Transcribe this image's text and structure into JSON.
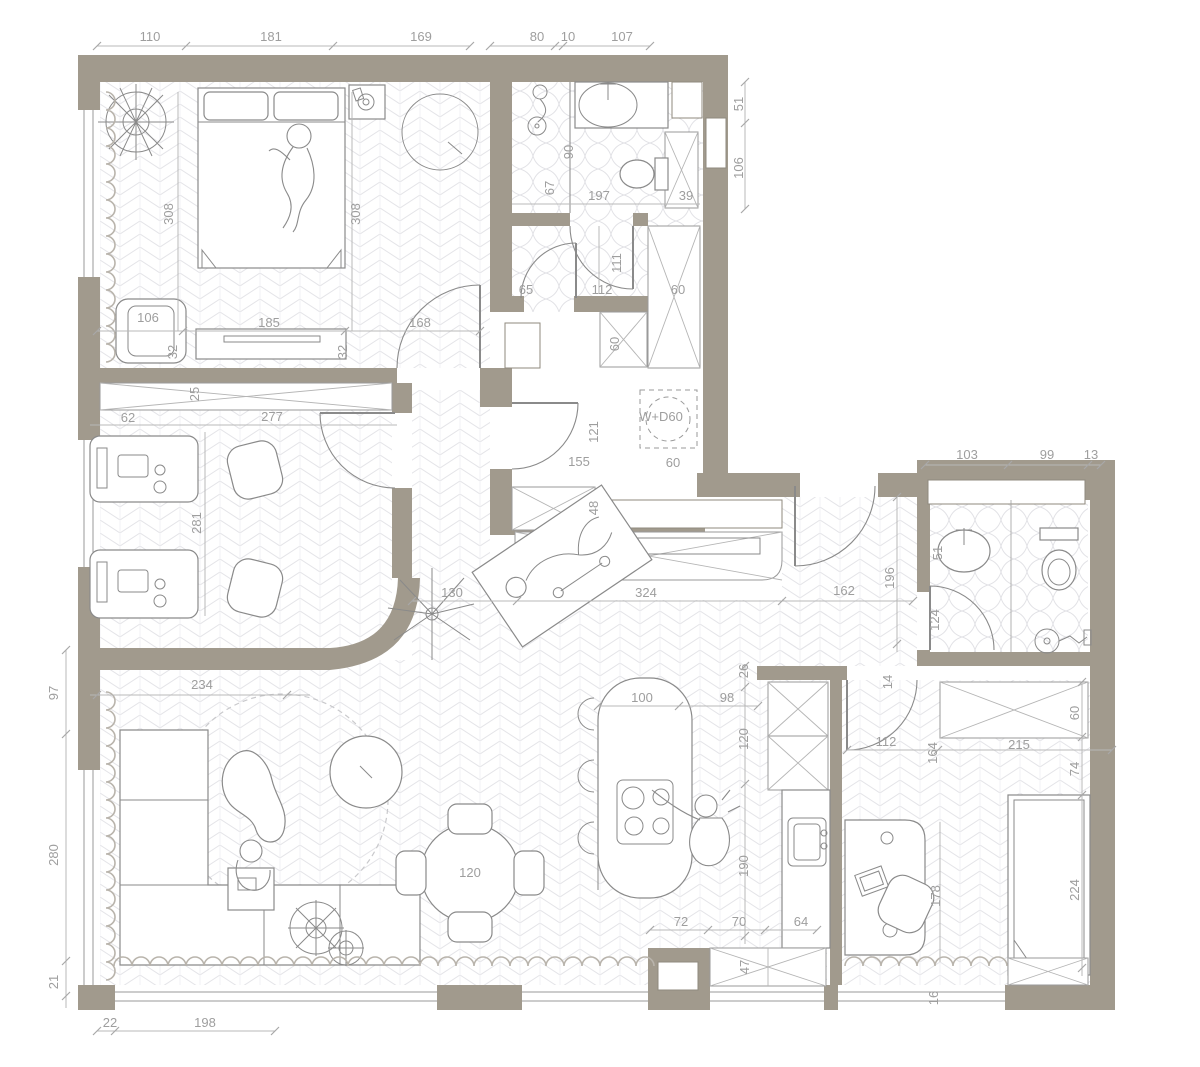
{
  "title": "Apartment floor plan with dimensions",
  "colors": {
    "wall": "#a19a8d",
    "dim_text": "#9e9e9e",
    "dim_line": "#b8b8b8",
    "furniture_line": "#8a8a8a",
    "curtain": "#b9b4ac",
    "floor_pattern": "#e4e4e8"
  },
  "labels": [
    {
      "t": "110",
      "x": 150,
      "y": 41
    },
    {
      "t": "181",
      "x": 271,
      "y": 41
    },
    {
      "t": "169",
      "x": 421,
      "y": 41
    },
    {
      "t": "80",
      "x": 537,
      "y": 41
    },
    {
      "t": "10",
      "x": 568,
      "y": 41
    },
    {
      "t": "107",
      "x": 622,
      "y": 41
    },
    {
      "t": "51",
      "x": 743,
      "y": 104,
      "r": 1
    },
    {
      "t": "106",
      "x": 743,
      "y": 168,
      "r": 1
    },
    {
      "t": "90",
      "x": 573,
      "y": 152,
      "r": 1
    },
    {
      "t": "67",
      "x": 554,
      "y": 188,
      "r": 1
    },
    {
      "t": "197",
      "x": 599,
      "y": 200
    },
    {
      "t": "39",
      "x": 686,
      "y": 200
    },
    {
      "t": "65",
      "x": 526,
      "y": 294
    },
    {
      "t": "112",
      "x": 602,
      "y": 294
    },
    {
      "t": "60",
      "x": 678,
      "y": 294
    },
    {
      "t": "111",
      "x": 621,
      "y": 263,
      "r": 1
    },
    {
      "t": "60",
      "x": 619,
      "y": 344,
      "r": 1
    },
    {
      "t": "308",
      "x": 173,
      "y": 214,
      "r": 1
    },
    {
      "t": "308",
      "x": 360,
      "y": 214,
      "r": 1
    },
    {
      "t": "106",
      "x": 148,
      "y": 322
    },
    {
      "t": "185",
      "x": 269,
      "y": 327
    },
    {
      "t": "168",
      "x": 420,
      "y": 327
    },
    {
      "t": "32",
      "x": 177,
      "y": 352,
      "r": 1
    },
    {
      "t": "32",
      "x": 347,
      "y": 352,
      "r": 1
    },
    {
      "t": "25",
      "x": 199,
      "y": 394,
      "r": 1
    },
    {
      "t": "62",
      "x": 128,
      "y": 422
    },
    {
      "t": "277",
      "x": 272,
      "y": 421
    },
    {
      "t": "281",
      "x": 201,
      "y": 523,
      "r": 1
    },
    {
      "t": "121",
      "x": 598,
      "y": 432,
      "r": 1
    },
    {
      "t": "W+D60",
      "x": 661,
      "y": 421
    },
    {
      "t": "155",
      "x": 579,
      "y": 466
    },
    {
      "t": "60",
      "x": 673,
      "y": 467
    },
    {
      "t": "48",
      "x": 598,
      "y": 508,
      "r": 1
    },
    {
      "t": "130",
      "x": 452,
      "y": 597
    },
    {
      "t": "324",
      "x": 646,
      "y": 597
    },
    {
      "t": "162",
      "x": 844,
      "y": 595
    },
    {
      "t": "196",
      "x": 894,
      "y": 578,
      "r": 1
    },
    {
      "t": "103",
      "x": 967,
      "y": 459
    },
    {
      "t": "99",
      "x": 1047,
      "y": 459
    },
    {
      "t": "13",
      "x": 1091,
      "y": 459
    },
    {
      "t": "51",
      "x": 942,
      "y": 553,
      "r": 1
    },
    {
      "t": "124",
      "x": 939,
      "y": 620,
      "r": 1
    },
    {
      "t": "26",
      "x": 748,
      "y": 671,
      "r": 1
    },
    {
      "t": "120",
      "x": 748,
      "y": 739,
      "r": 1
    },
    {
      "t": "190",
      "x": 748,
      "y": 866,
      "r": 1
    },
    {
      "t": "14",
      "x": 892,
      "y": 682,
      "r": 1
    },
    {
      "t": "112",
      "x": 886,
      "y": 746
    },
    {
      "t": "164",
      "x": 937,
      "y": 753,
      "r": 1
    },
    {
      "t": "215",
      "x": 1019,
      "y": 749
    },
    {
      "t": "74",
      "x": 1079,
      "y": 769,
      "r": 1
    },
    {
      "t": "60",
      "x": 1079,
      "y": 713,
      "r": 1
    },
    {
      "t": "224",
      "x": 1079,
      "y": 890,
      "r": 1
    },
    {
      "t": "178",
      "x": 940,
      "y": 896,
      "r": 1
    },
    {
      "t": "16",
      "x": 938,
      "y": 998,
      "r": 1
    },
    {
      "t": "100",
      "x": 642,
      "y": 702
    },
    {
      "t": "98",
      "x": 727,
      "y": 702
    },
    {
      "t": "72",
      "x": 681,
      "y": 926
    },
    {
      "t": "70",
      "x": 739,
      "y": 926
    },
    {
      "t": "64",
      "x": 801,
      "y": 926
    },
    {
      "t": "47",
      "x": 749,
      "y": 967,
      "r": 1
    },
    {
      "t": "97",
      "x": 58,
      "y": 693,
      "r": 1
    },
    {
      "t": "280",
      "x": 58,
      "y": 855,
      "r": 1
    },
    {
      "t": "21",
      "x": 58,
      "y": 982,
      "r": 1
    },
    {
      "t": "22",
      "x": 110,
      "y": 1027
    },
    {
      "t": "198",
      "x": 205,
      "y": 1027
    },
    {
      "t": "234",
      "x": 202,
      "y": 689
    },
    {
      "t": "120",
      "x": 470,
      "y": 877
    }
  ]
}
